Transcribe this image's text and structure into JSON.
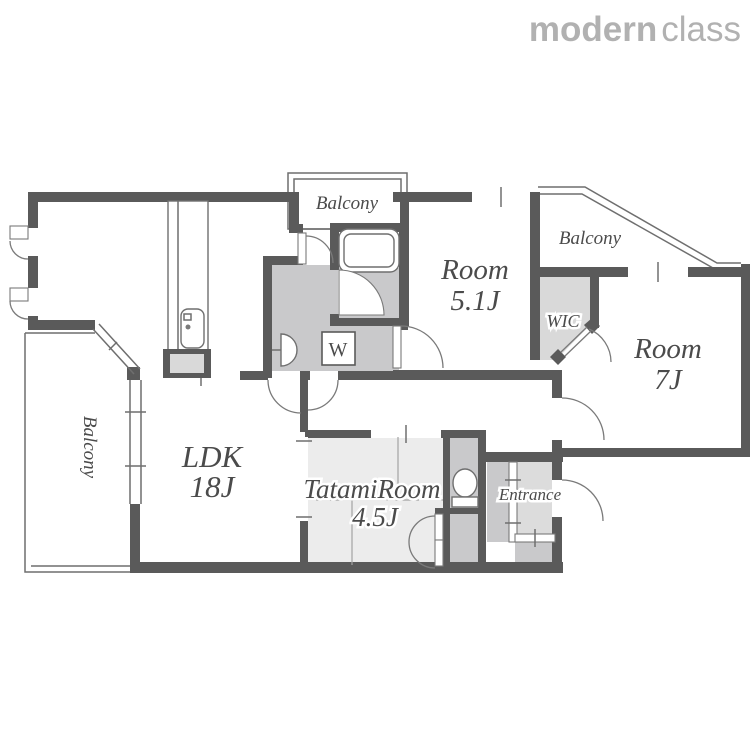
{
  "brand": {
    "name_bold": "modern",
    "name_light": "class"
  },
  "labels": {
    "balcony_top": "Balcony",
    "balcony_right": "Balcony",
    "balcony_left": "Balcony",
    "room_51_line1": "Room",
    "room_51_line2": "5.1J",
    "room_7_line1": "Room",
    "room_7_line2": "7J",
    "ldk_line1": "LDK",
    "ldk_line2": "18J",
    "tatami_line1": "TatamiRoom",
    "tatami_line2": "4.5J",
    "wic": "WIC",
    "entrance": "Entrance",
    "washing_machine": "W"
  },
  "colors": {
    "wall": "#5a5a5a",
    "wet_area": "#c9c9cb",
    "closet_area": "#d9d9d9",
    "tatami": "#ececec",
    "label_text": "#4b4b4b",
    "logo": "#b1b1b1",
    "background": "#ffffff"
  }
}
